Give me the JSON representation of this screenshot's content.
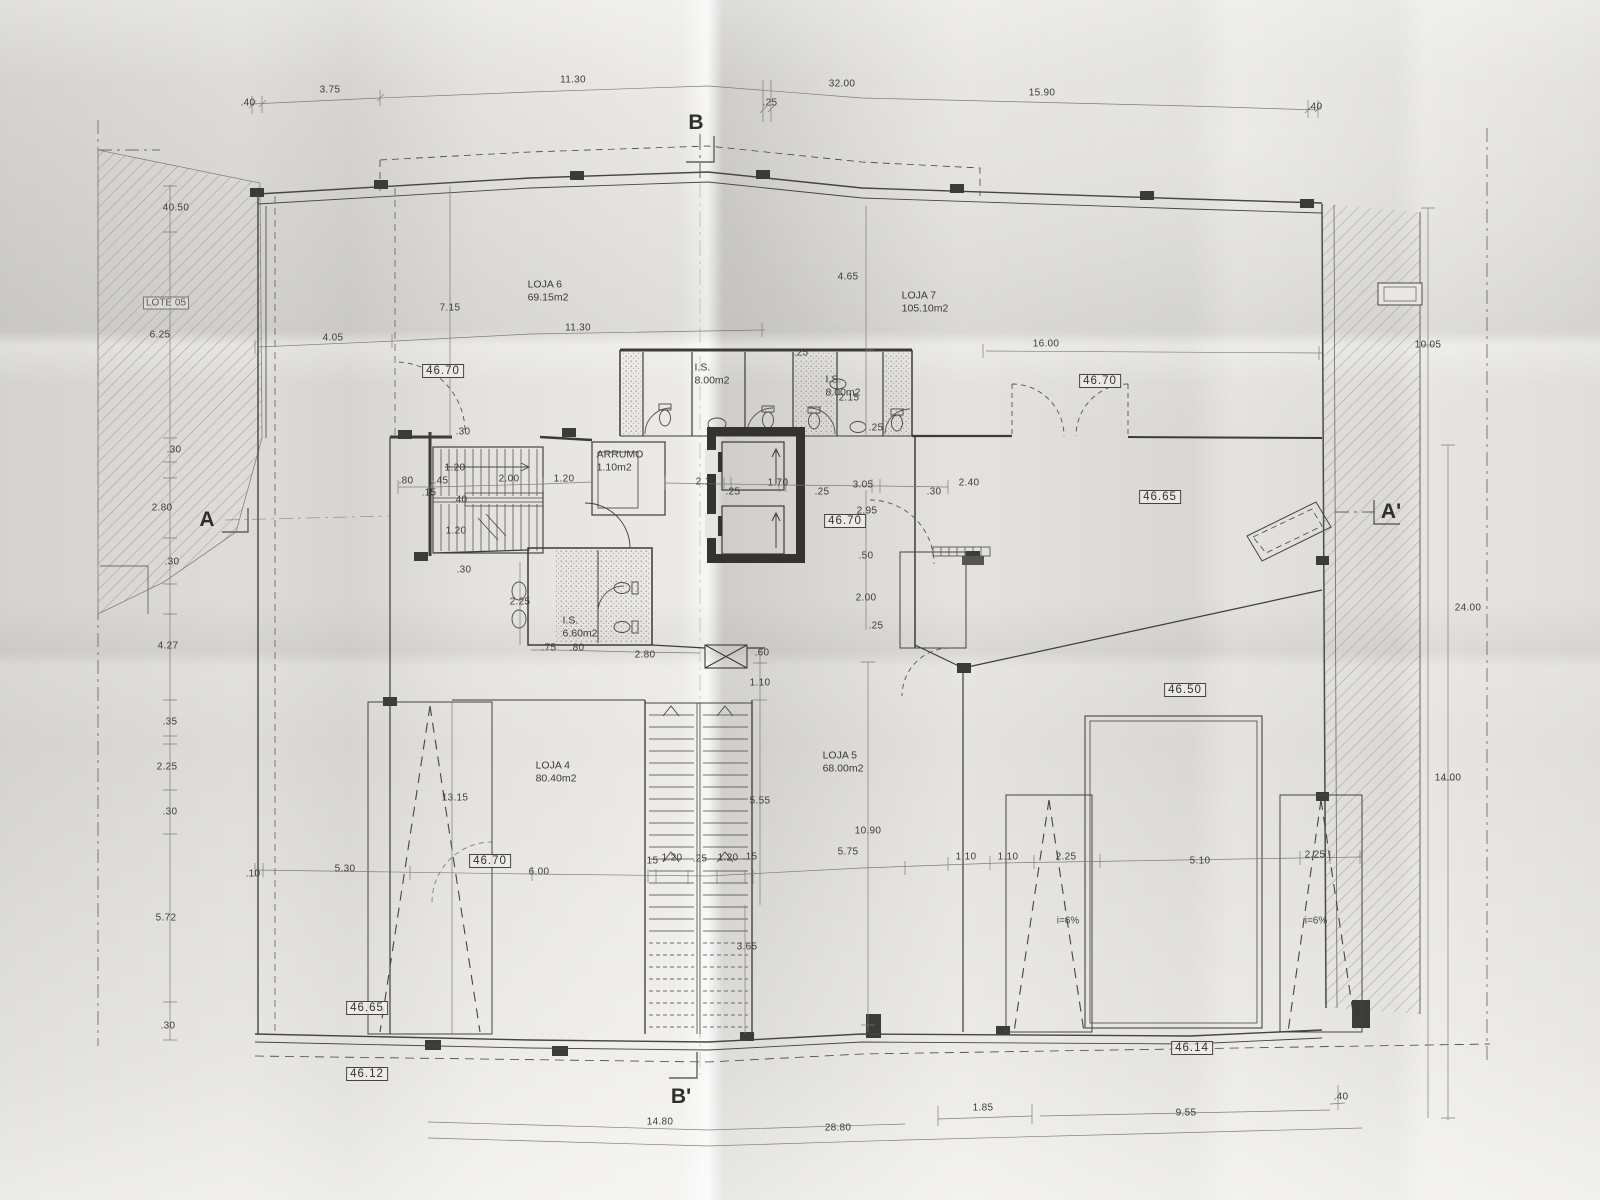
{
  "drawing": {
    "section_markers": [
      {
        "label": "B",
        "x": 696,
        "y": 123
      },
      {
        "label": "B'",
        "x": 681,
        "y": 1097
      },
      {
        "label": "A",
        "x": 207,
        "y": 520
      },
      {
        "label": "A'",
        "x": 1391,
        "y": 512
      }
    ],
    "level_markers": [
      {
        "value": "46.70",
        "x": 443,
        "y": 371
      },
      {
        "value": "46.70",
        "x": 1100,
        "y": 381
      },
      {
        "value": "46.70",
        "x": 845,
        "y": 521
      },
      {
        "value": "46.65",
        "x": 1160,
        "y": 497
      },
      {
        "value": "46.50",
        "x": 1185,
        "y": 690
      },
      {
        "value": "46.70",
        "x": 490,
        "y": 861
      },
      {
        "value": "46.65",
        "x": 367,
        "y": 1008
      },
      {
        "value": "46.12",
        "x": 367,
        "y": 1074
      },
      {
        "value": "46.14",
        "x": 1192,
        "y": 1048
      }
    ],
    "rooms": [
      {
        "name": "LOJA 6",
        "area": "69.15m2",
        "x": 548,
        "y": 291
      },
      {
        "name": "LOJA 7",
        "area": "105.10m2",
        "x": 925,
        "y": 302
      },
      {
        "name": "LOJA 4",
        "area": "80.40m2",
        "x": 556,
        "y": 772
      },
      {
        "name": "LOJA 5",
        "area": "68.00m2",
        "x": 843,
        "y": 762
      },
      {
        "name": "I.S.",
        "area": "8.00m2",
        "x": 712,
        "y": 374
      },
      {
        "name": "I.S.",
        "area": "8.00m2",
        "x": 843,
        "y": 386
      },
      {
        "name": "I.S.",
        "area": "6.60m2",
        "x": 580,
        "y": 627
      },
      {
        "name": "ARRUMO",
        "area": "1.10m2",
        "x": 620,
        "y": 461
      }
    ],
    "zones": [
      {
        "label": "LOTE 05",
        "x": 166,
        "y": 303
      }
    ],
    "ramp_labels": [
      {
        "text": "i=6%",
        "x": 1068,
        "y": 921
      },
      {
        "text": "i=6%",
        "x": 1316,
        "y": 921
      }
    ],
    "dimensions": [
      {
        "t": ".40",
        "x": 248,
        "y": 103
      },
      {
        "t": "3.75",
        "x": 330,
        "y": 90
      },
      {
        "t": "11.30",
        "x": 573,
        "y": 80
      },
      {
        "t": "32.00",
        "x": 842,
        "y": 84
      },
      {
        "t": ".25",
        "x": 770,
        "y": 103,
        "r": 1
      },
      {
        "t": "15.90",
        "x": 1042,
        "y": 93
      },
      {
        "t": ".40",
        "x": 1315,
        "y": 107
      },
      {
        "t": "4.05",
        "x": 333,
        "y": 338
      },
      {
        "t": "7.15",
        "x": 450,
        "y": 308,
        "r": 1
      },
      {
        "t": "11.30",
        "x": 578,
        "y": 328
      },
      {
        "t": "16.00",
        "x": 1046,
        "y": 344
      },
      {
        "t": "4.65",
        "x": 848,
        "y": 277,
        "r": 1
      },
      {
        "t": ".25",
        "x": 801,
        "y": 353,
        "r": 1
      },
      {
        "t": "2.15",
        "x": 849,
        "y": 398,
        "r": 1
      },
      {
        "t": ".25",
        "x": 876,
        "y": 428,
        "r": 1
      },
      {
        "t": "40.50",
        "x": 176,
        "y": 208,
        "r": 1
      },
      {
        "t": "6.25",
        "x": 160,
        "y": 335,
        "r": 1
      },
      {
        "t": ".30",
        "x": 174,
        "y": 450,
        "r": 1
      },
      {
        "t": "2.80",
        "x": 162,
        "y": 508,
        "r": 1
      },
      {
        "t": ".30",
        "x": 172,
        "y": 562,
        "r": 1
      },
      {
        "t": "4.27",
        "x": 168,
        "y": 646,
        "r": 1
      },
      {
        "t": ".35",
        "x": 170,
        "y": 722,
        "r": 1
      },
      {
        "t": "2.25",
        "x": 167,
        "y": 767,
        "r": 1
      },
      {
        "t": ".30",
        "x": 170,
        "y": 812,
        "r": 1
      },
      {
        "t": "5.72",
        "x": 166,
        "y": 918,
        "r": 1
      },
      {
        "t": ".30",
        "x": 168,
        "y": 1026,
        "r": 1
      },
      {
        "t": ".80",
        "x": 406,
        "y": 481
      },
      {
        "t": "1.45",
        "x": 438,
        "y": 481
      },
      {
        "t": ".15",
        "x": 429,
        "y": 493
      },
      {
        "t": "1.20",
        "x": 455,
        "y": 468,
        "r": 1
      },
      {
        "t": ".30",
        "x": 463,
        "y": 432,
        "r": 1
      },
      {
        "t": "2.00",
        "x": 509,
        "y": 479
      },
      {
        "t": "1.20",
        "x": 564,
        "y": 479
      },
      {
        "t": ".40",
        "x": 460,
        "y": 500,
        "r": 1
      },
      {
        "t": "1.20",
        "x": 456,
        "y": 531,
        "r": 1
      },
      {
        "t": ".30",
        "x": 464,
        "y": 570,
        "r": 1
      },
      {
        "t": "2.10",
        "x": 706,
        "y": 482
      },
      {
        "t": ".25",
        "x": 733,
        "y": 492
      },
      {
        "t": "1.70",
        "x": 778,
        "y": 483
      },
      {
        "t": ".25",
        "x": 822,
        "y": 492
      },
      {
        "t": "3.05",
        "x": 863,
        "y": 485
      },
      {
        "t": "2.95",
        "x": 867,
        "y": 511,
        "r": 1
      },
      {
        "t": ".30",
        "x": 934,
        "y": 492
      },
      {
        "t": "2.40",
        "x": 969,
        "y": 483
      },
      {
        "t": ".50",
        "x": 866,
        "y": 556,
        "r": 1
      },
      {
        "t": "2.00",
        "x": 866,
        "y": 598,
        "r": 1
      },
      {
        "t": ".25",
        "x": 876,
        "y": 626,
        "r": 1
      },
      {
        "t": "2.25",
        "x": 520,
        "y": 602,
        "r": 1
      },
      {
        "t": ".75",
        "x": 549,
        "y": 648
      },
      {
        "t": ".80",
        "x": 577,
        "y": 648
      },
      {
        "t": "2.80",
        "x": 645,
        "y": 655
      },
      {
        "t": ".60",
        "x": 762,
        "y": 653,
        "r": 1
      },
      {
        "t": "1.10",
        "x": 760,
        "y": 683,
        "r": 1
      },
      {
        "t": "5.55",
        "x": 760,
        "y": 801,
        "r": 1
      },
      {
        "t": "10.90",
        "x": 868,
        "y": 831,
        "r": 1
      },
      {
        "t": "13.15",
        "x": 455,
        "y": 798,
        "r": 1
      },
      {
        "t": "3.65",
        "x": 747,
        "y": 947,
        "r": 1
      },
      {
        "t": ".10",
        "x": 253,
        "y": 874
      },
      {
        "t": "5.30",
        "x": 345,
        "y": 869
      },
      {
        "t": "6.00",
        "x": 539,
        "y": 872
      },
      {
        "t": ".15",
        "x": 651,
        "y": 861
      },
      {
        "t": "1.20",
        "x": 672,
        "y": 858
      },
      {
        "t": ".25",
        "x": 700,
        "y": 859
      },
      {
        "t": "1.20",
        "x": 728,
        "y": 858
      },
      {
        "t": ".15",
        "x": 750,
        "y": 857
      },
      {
        "t": "5.75",
        "x": 848,
        "y": 852
      },
      {
        "t": "1.10",
        "x": 966,
        "y": 857
      },
      {
        "t": "1.10",
        "x": 1008,
        "y": 857
      },
      {
        "t": "2.25",
        "x": 1066,
        "y": 857
      },
      {
        "t": "5.10",
        "x": 1200,
        "y": 861
      },
      {
        "t": "2.25",
        "x": 1315,
        "y": 855
      },
      {
        "t": "14.80",
        "x": 660,
        "y": 1122
      },
      {
        "t": "28.80",
        "x": 838,
        "y": 1128
      },
      {
        "t": "1.85",
        "x": 983,
        "y": 1108
      },
      {
        "t": "9.55",
        "x": 1186,
        "y": 1113
      },
      {
        "t": ".40",
        "x": 1341,
        "y": 1097
      },
      {
        "t": "10.05",
        "x": 1428,
        "y": 345,
        "r": 1
      },
      {
        "t": "24.00",
        "x": 1468,
        "y": 608,
        "r": 1
      },
      {
        "t": "14.00",
        "x": 1448,
        "y": 778,
        "r": 1
      }
    ]
  }
}
